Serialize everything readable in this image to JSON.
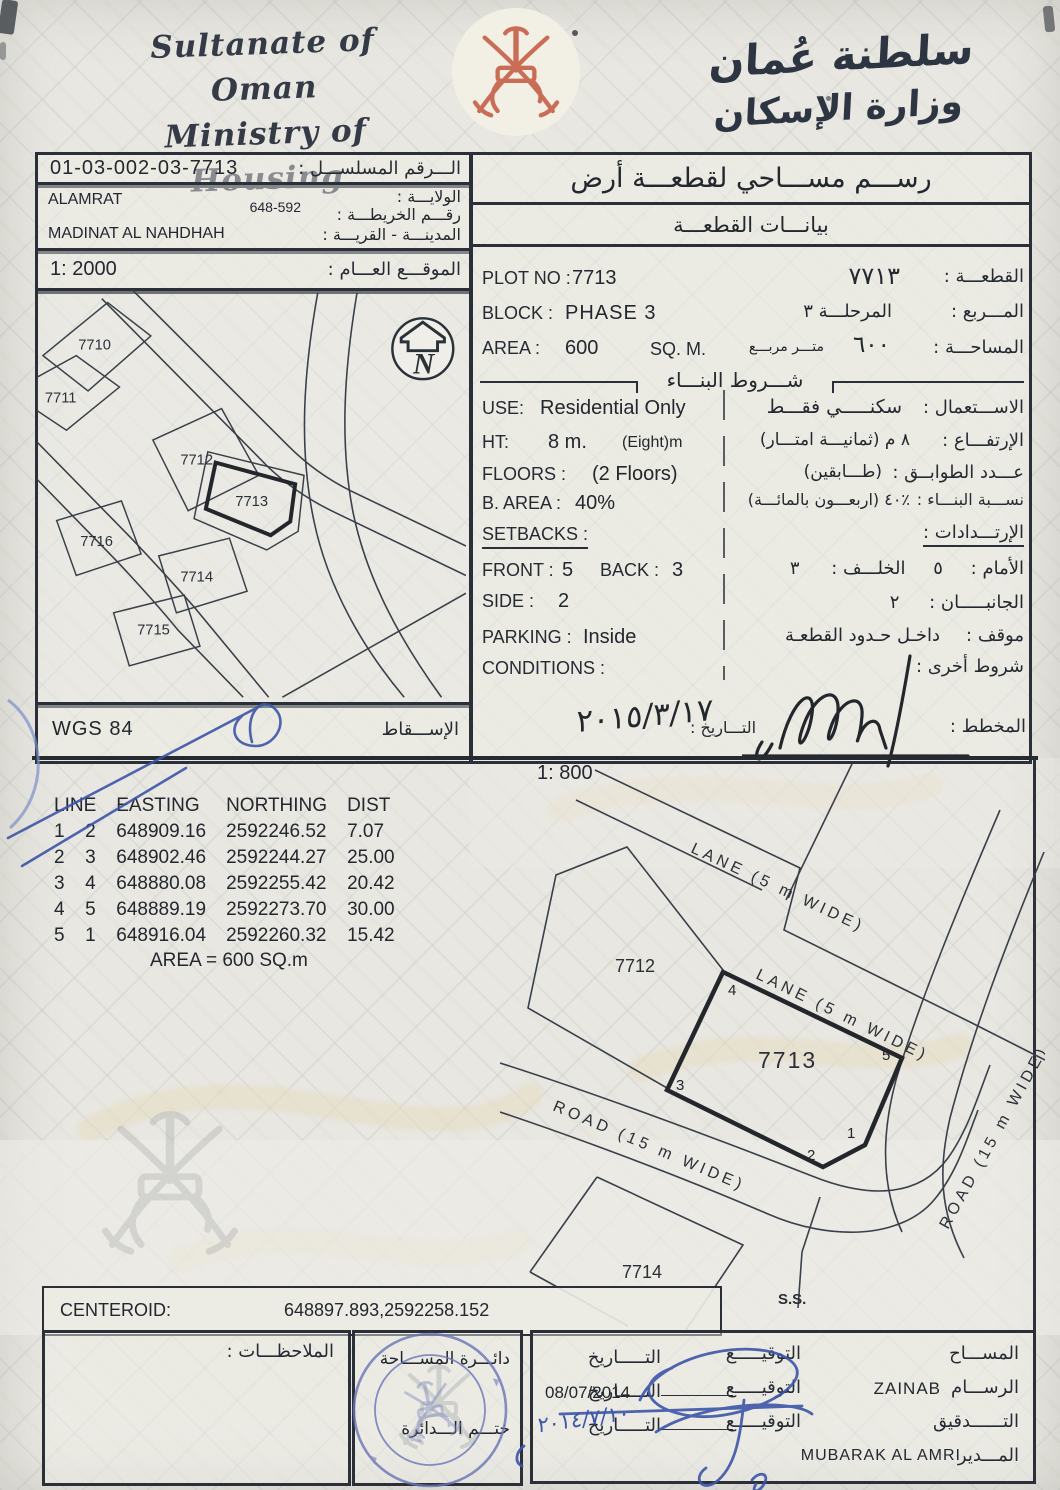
{
  "header": {
    "en_line1": "Sultanate of Oman",
    "en_line2": "Ministry of Housing",
    "ar_line1": "سلطنة عُمان",
    "ar_line2": "وزارة الإسكان"
  },
  "ref": {
    "serial_label_ar": "الـــرقم المسلســـل :",
    "serial_value": "01-03-002-03-7713",
    "wilayat_value": "ALAMRAT",
    "wilayat_label_ar": "الولايـــة :",
    "map_no_value": "648-592",
    "map_no_label_ar": "رقـــم الخريطـــة :",
    "town_value": "MADINAT  AL NAHDHAH",
    "town_label_ar": "المدينـــة - القريـــة :",
    "overview_scale": "1: 2000",
    "overview_label_ar": "الموقـــع العـــام :",
    "projection_value": "WGS 84",
    "projection_label_ar": "الإســـقاط"
  },
  "title": {
    "main_ar": "رســـم مســـاحي لقطعـــة أرض",
    "sub_ar": "بيانـــات القطعـــة"
  },
  "plot": {
    "plot_no_label": "PLOT NO :",
    "plot_no": "7713",
    "plot_no_ar": "٧٧١٣",
    "plot_no_label_ar": "القطعـــة :",
    "block_label": "BLOCK :",
    "block": "PHASE 3",
    "block_ar": "المرحلـــة ٣",
    "block_label_ar": "المـــربع :",
    "area_label": "AREA :",
    "area": "600",
    "area_unit": "SQ. M.",
    "area_ar": "٦٠٠",
    "area_unit_ar": "متـــر مربـــع",
    "area_label_ar": "المساحـــة :"
  },
  "conditions": {
    "header_ar": "شـــروط البنـــاء",
    "use_label": "USE:",
    "use": "Residential Only",
    "use_ar": "سكنـــــي فقـــط",
    "use_label_ar": "الاســـتعمال :",
    "ht_label": "HT:",
    "ht": "8 m.",
    "ht_note": "(Eight)m",
    "ht_ar": "٨   م   (ثمانيـــة امتـــار)",
    "ht_label_ar": "الإرتفـــاع :",
    "floors_label": "FLOORS :",
    "floors": "(2 Floors)",
    "floors_ar": "(طـــابقين)",
    "floors_label_ar": "عـــدد الطوابــق :",
    "barea_label": "B. AREA :",
    "barea": "40%",
    "barea_ar": "٪٤٠  (اربعـــون بالمائـــة)",
    "barea_label_ar": "نســـبة البنـــاء :",
    "setbacks_label": "SETBACKS :",
    "setbacks_label_ar": "الإرتـــدادات :",
    "front_label": "FRONT :",
    "front": "5",
    "back_label": "BACK :",
    "back": "3",
    "front_label_ar": "الأمام :",
    "front_ar": "٥",
    "back_label_ar": "الخلـــف :",
    "back_ar": "٣",
    "side_label": "SIDE :",
    "side": "2",
    "side_label_ar": "الجانبـــــان :",
    "side_ar": "٢",
    "parking_label": "PARKING :",
    "parking": "Inside",
    "parking_label_ar": "موقف :",
    "parking_ar": "داخـل حـدود القطعـة",
    "cond_label": "CONDITIONS :",
    "cond_label_ar": "شروط أخرى :"
  },
  "planner": {
    "date_label_ar": "التـــاريخ :",
    "date_handwritten": "٢٠١٥/٣/١٧",
    "label_ar": "المخطط :"
  },
  "detail": {
    "scale": "1: 800"
  },
  "coords": {
    "headers": [
      "LINE",
      "EASTING",
      "NORTHING",
      "DIST"
    ],
    "rows": [
      [
        "1",
        "2",
        "648909.16",
        "2592246.52",
        "7.07"
      ],
      [
        "2",
        "3",
        "648902.46",
        "2592244.27",
        "25.00"
      ],
      [
        "3",
        "4",
        "648880.08",
        "2592255.42",
        "20.42"
      ],
      [
        "4",
        "5",
        "648889.19",
        "2592273.70",
        "30.00"
      ],
      [
        "5",
        "1",
        "648916.04",
        "2592260.32",
        "15.42"
      ]
    ],
    "area_note": "AREA = 600  SQ.m"
  },
  "overview_map": {
    "plots": [
      "7710",
      "7711",
      "7712",
      "7713",
      "7716",
      "7714",
      "7715"
    ],
    "north_label": "N"
  },
  "detail_map": {
    "lane1": "LANE (5 m WIDE)",
    "lane2": "LANE (5 m WIDE)",
    "road_bottom": "ROAD (15 m WIDE)",
    "road_right": "ROAD (15 m WIDE)",
    "plot_left": "7712",
    "plot_main": "7713",
    "plot_below": "7714",
    "ss": "S.S.",
    "vertices": [
      "1",
      "2",
      "3",
      "4",
      "5"
    ]
  },
  "centeroid": {
    "label": "CENTEROID:",
    "value": "648897.893,2592258.152"
  },
  "footer": {
    "notes_label_ar": "الملاحظـــات :",
    "dept_line1_ar": "دائـــرة المســـاحة",
    "dept_line2_ar": "ختـــم الـــدائرة",
    "surveyor_label_ar": "المســـاح",
    "sign_label_ar": "التوقيـــــع",
    "date_label_ar": "التـــــاريخ",
    "draftsman_label_ar": "الرســـام",
    "draftsman_name": "ZAINAB",
    "draft_date": "08/07/2014",
    "audit_label_ar": "التــــــدقيق",
    "audit_date_handwritten": "٢٠١٤/٧/١٠",
    "director_label_ar": "المـــدير",
    "director_name": "MUBARAK AL AMRI"
  },
  "colors": {
    "ink": "#272c33",
    "blue_pen": "#3d55a8",
    "stamp_blue": "#6a74b6",
    "emblem_red": "#c4573e",
    "paper": "#e8e7e1"
  }
}
